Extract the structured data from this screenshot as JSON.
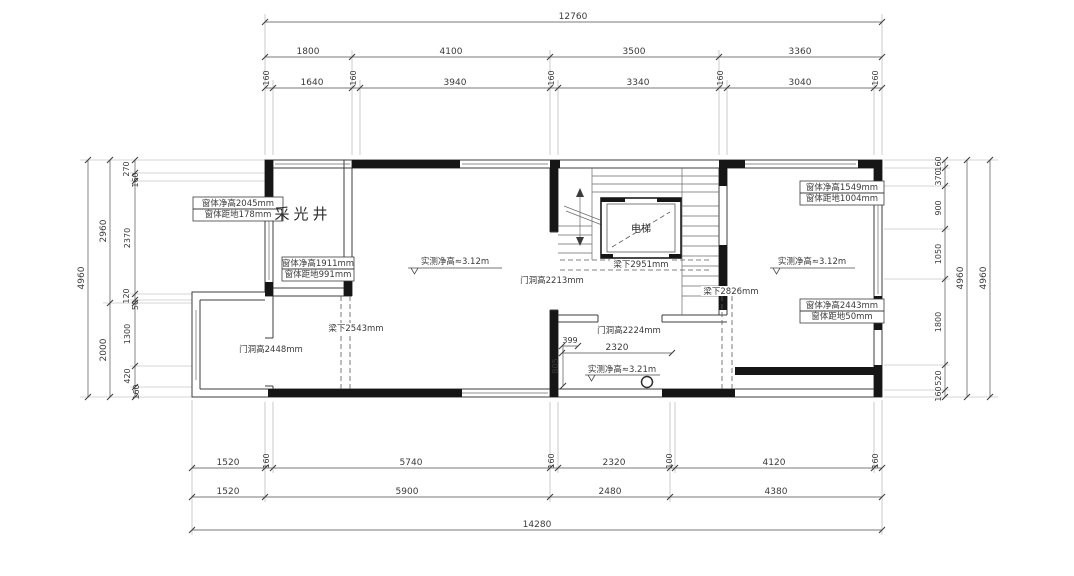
{
  "drawing_type": "floor-plan",
  "dimensions": {
    "top": {
      "overall": "12760",
      "row2": [
        "1800",
        "4100",
        "3500",
        "3360"
      ],
      "row3": [
        "160",
        "1640",
        "160",
        "3940",
        "160",
        "3340",
        "160",
        "3040",
        "160"
      ]
    },
    "bottom": {
      "row1": [
        "1520",
        "160",
        "5740",
        "160",
        "2320",
        "100",
        "4120",
        "160"
      ],
      "row2": [
        "1520",
        "5900",
        "2480",
        "4380"
      ],
      "overall": "14280"
    },
    "left": {
      "overall": "4960",
      "mid": [
        "2960",
        "2000"
      ],
      "inner": [
        "270",
        "160",
        "2370",
        "120",
        "50",
        "1300",
        "420",
        "160"
      ]
    },
    "right": {
      "inner": [
        "160",
        "370",
        "900",
        "1050",
        "1800",
        "520",
        "160"
      ],
      "outer": [
        "4960",
        "4960"
      ]
    },
    "interior": {
      "w2320": "2320",
      "w399": "399",
      "h805": "805"
    }
  },
  "labels": {
    "light_well": "采光井",
    "elevator": "电梯",
    "window_a1": "窗体净高2045mm",
    "window_a2": "窗体距地178mm",
    "window_b1": "窗体净高1911mm",
    "window_b2": "窗体距地991mm",
    "window_c1": "窗体净高1549mm",
    "window_c2": "窗体距地1004mm",
    "window_d1": "窗体净高2443mm",
    "window_d2": "窗体距地50mm",
    "door_2448": "门洞高2448mm",
    "door_2213": "门洞高2213mm",
    "door_2224": "门洞高2224mm",
    "beam_2543": "梁下2543mm",
    "beam_2951": "梁下2951mm",
    "beam_2826": "梁下2826mm",
    "ceiling_mid": "实测净高≈3.12m",
    "ceiling_right": "实测净高≈3.12m",
    "ceiling_bottom": "实测净高≈3.21m"
  },
  "colors": {
    "wall": "#161616",
    "dimension_line": "#7a7a7a",
    "text": "#3a3a3a",
    "background": "#ffffff"
  }
}
